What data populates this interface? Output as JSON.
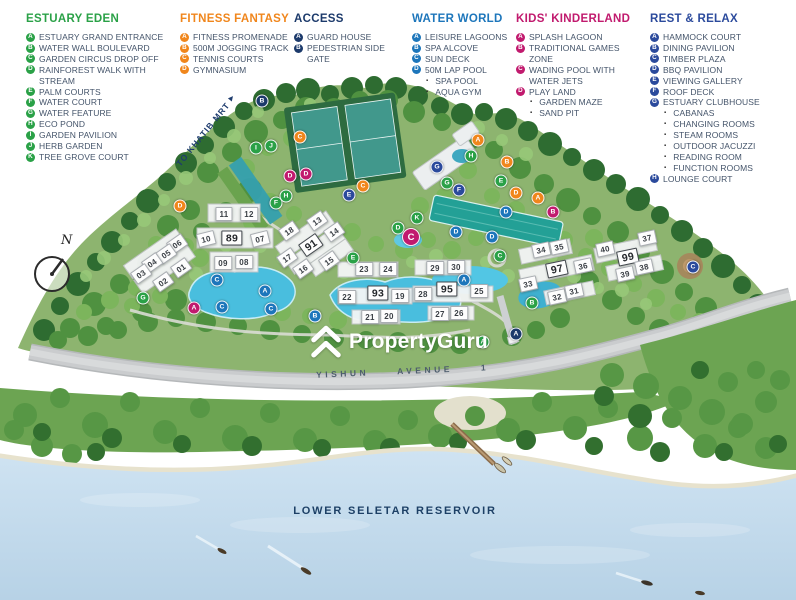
{
  "colors": {
    "estuary": "#2aa147",
    "fitness": "#f0861c",
    "access": "#1c3a6b",
    "water": "#1d76bb",
    "kids": "#c11a6e",
    "rest": "#2b4a9c"
  },
  "legend": [
    {
      "id": "estuary-eden",
      "title": "ESTUARY EDEN",
      "color": "#2aa147",
      "items": [
        {
          "k": "A",
          "label": "ESTUARY GRAND ENTRANCE"
        },
        {
          "k": "B",
          "label": "WATER WALL BOULEVARD"
        },
        {
          "k": "C",
          "label": "GARDEN CIRCUS DROP OFF"
        },
        {
          "k": "D",
          "label": "RAINFOREST WALK WITH STREAM"
        },
        {
          "k": "E",
          "label": "PALM COURTS"
        },
        {
          "k": "F",
          "label": "WATER COURT"
        },
        {
          "k": "G",
          "label": "WATER FEATURE"
        },
        {
          "k": "H",
          "label": "ECO POND"
        },
        {
          "k": "I",
          "label": "GARDEN PAVILION"
        },
        {
          "k": "J",
          "label": "HERB GARDEN"
        },
        {
          "k": "K",
          "label": "TREE GROVE COURT"
        }
      ]
    },
    {
      "id": "fitness-fantasy",
      "title": "FITNESS FANTASY",
      "color": "#f0861c",
      "items": [
        {
          "k": "A",
          "label": "FITNESS PROMENADE"
        },
        {
          "k": "B",
          "label": "500M JOGGING TRACK"
        },
        {
          "k": "C",
          "label": "TENNIS COURTS"
        },
        {
          "k": "D",
          "label": "GYMNASIUM"
        }
      ]
    },
    {
      "id": "access",
      "title": "ACCESS",
      "color": "#1c3a6b",
      "items": [
        {
          "k": "A",
          "label": "GUARD HOUSE"
        },
        {
          "k": "B",
          "label": "PEDESTRIAN SIDE GATE"
        }
      ]
    },
    {
      "id": "water-world",
      "title": "WATER WORLD",
      "color": "#1d76bb",
      "items": [
        {
          "k": "A",
          "label": "LEISURE LAGOONS"
        },
        {
          "k": "B",
          "label": "SPA ALCOVE"
        },
        {
          "k": "C",
          "label": "SUN DECK"
        },
        {
          "k": "D",
          "label": "50M LAP POOL"
        },
        {
          "label": "SPA POOL",
          "sub": true
        },
        {
          "label": "AQUA GYM",
          "sub": true
        }
      ]
    },
    {
      "id": "kids-kinderland",
      "title": "KIDS' KINDERLAND",
      "color": "#c11a6e",
      "items": [
        {
          "k": "A",
          "label": "SPLASH LAGOON"
        },
        {
          "k": "B",
          "label": "TRADITIONAL GAMES ZONE"
        },
        {
          "k": "C",
          "label": "WADING POOL WITH WATER JETS"
        },
        {
          "k": "D",
          "label": "PLAY LAND"
        },
        {
          "label": "GARDEN MAZE",
          "sub": true
        },
        {
          "label": "SAND PIT",
          "sub": true
        }
      ]
    },
    {
      "id": "rest-relax",
      "title": "REST & RELAX",
      "color": "#2b4a9c",
      "items": [
        {
          "k": "A",
          "label": "HAMMOCK COURT"
        },
        {
          "k": "B",
          "label": "DINING PAVILION"
        },
        {
          "k": "C",
          "label": "TIMBER PLAZA"
        },
        {
          "k": "D",
          "label": "BBQ PAVILION"
        },
        {
          "k": "E",
          "label": "VIEWING GALLERY"
        },
        {
          "k": "F",
          "label": "ROOF DECK"
        },
        {
          "k": "G",
          "label": "ESTUARY CLUBHOUSE"
        },
        {
          "label": "CABANAS",
          "sub": true
        },
        {
          "label": "CHANGING ROOMS",
          "sub": true
        },
        {
          "label": "STEAM ROOMS",
          "sub": true
        },
        {
          "label": "OUTDOOR JACUZZI",
          "sub": true
        },
        {
          "label": "READING ROOM",
          "sub": true
        },
        {
          "label": "FUNCTION ROOMS",
          "sub": true
        },
        {
          "k": "H",
          "label": "LOUNGE COURT"
        }
      ]
    }
  ],
  "map": {
    "khatib_label": "TO KHATIB MRT",
    "north_label": "N",
    "watermark": "PropertyGuru",
    "road_words": [
      "YISHUN",
      "AVENUE",
      "1"
    ],
    "reservoir_label": "LOWER SELETAR RESERVOIR",
    "buildings": [
      {
        "n": "11",
        "x": 224,
        "y": 214,
        "r": 0
      },
      {
        "n": "12",
        "x": 249,
        "y": 214,
        "r": 0
      },
      {
        "n": "10",
        "x": 206,
        "y": 239,
        "r": -14
      },
      {
        "n": "89",
        "x": 232,
        "y": 238,
        "r": 0,
        "b": true
      },
      {
        "n": "07",
        "x": 260,
        "y": 239,
        "r": -14
      },
      {
        "n": "09",
        "x": 223,
        "y": 263,
        "r": 0
      },
      {
        "n": "08",
        "x": 244,
        "y": 262,
        "r": 0
      },
      {
        "n": "06",
        "x": 177,
        "y": 244,
        "r": -35
      },
      {
        "n": "05",
        "x": 166,
        "y": 254,
        "r": -35
      },
      {
        "n": "04",
        "x": 152,
        "y": 263,
        "r": -35
      },
      {
        "n": "03",
        "x": 141,
        "y": 274,
        "r": -35
      },
      {
        "n": "02",
        "x": 163,
        "y": 282,
        "r": -35
      },
      {
        "n": "01",
        "x": 181,
        "y": 268,
        "r": -35
      },
      {
        "n": "18",
        "x": 289,
        "y": 231,
        "r": -35
      },
      {
        "n": "13",
        "x": 317,
        "y": 221,
        "r": -35
      },
      {
        "n": "14",
        "x": 334,
        "y": 232,
        "r": -35
      },
      {
        "n": "91",
        "x": 311,
        "y": 245,
        "r": -35,
        "b": true
      },
      {
        "n": "17",
        "x": 287,
        "y": 258,
        "r": -35
      },
      {
        "n": "15",
        "x": 329,
        "y": 261,
        "r": -35
      },
      {
        "n": "16",
        "x": 303,
        "y": 269,
        "r": -35
      },
      {
        "n": "23",
        "x": 364,
        "y": 269,
        "r": 0
      },
      {
        "n": "24",
        "x": 388,
        "y": 269,
        "r": 0
      },
      {
        "n": "22",
        "x": 347,
        "y": 297,
        "r": 0
      },
      {
        "n": "93",
        "x": 378,
        "y": 293,
        "r": 0,
        "b": true
      },
      {
        "n": "19",
        "x": 400,
        "y": 296,
        "r": 0
      },
      {
        "n": "21",
        "x": 370,
        "y": 317,
        "r": 0
      },
      {
        "n": "20",
        "x": 389,
        "y": 316,
        "r": 0
      },
      {
        "n": "29",
        "x": 435,
        "y": 268,
        "r": 0
      },
      {
        "n": "30",
        "x": 456,
        "y": 267,
        "r": 0
      },
      {
        "n": "28",
        "x": 423,
        "y": 294,
        "r": 0
      },
      {
        "n": "95",
        "x": 447,
        "y": 289,
        "r": 0,
        "b": true
      },
      {
        "n": "25",
        "x": 479,
        "y": 291,
        "r": 0
      },
      {
        "n": "27",
        "x": 440,
        "y": 314,
        "r": 0
      },
      {
        "n": "26",
        "x": 459,
        "y": 313,
        "r": 0
      },
      {
        "n": "34",
        "x": 541,
        "y": 250,
        "r": -12
      },
      {
        "n": "35",
        "x": 559,
        "y": 247,
        "r": -12
      },
      {
        "n": "97",
        "x": 557,
        "y": 269,
        "r": -12,
        "b": true
      },
      {
        "n": "36",
        "x": 583,
        "y": 266,
        "r": -12
      },
      {
        "n": "33",
        "x": 528,
        "y": 284,
        "r": -12
      },
      {
        "n": "32",
        "x": 557,
        "y": 297,
        "r": -12
      },
      {
        "n": "31",
        "x": 574,
        "y": 291,
        "r": -12
      },
      {
        "n": "40",
        "x": 605,
        "y": 249,
        "r": -12
      },
      {
        "n": "37",
        "x": 647,
        "y": 238,
        "r": -12
      },
      {
        "n": "99",
        "x": 628,
        "y": 257,
        "r": -12,
        "b": true
      },
      {
        "n": "39",
        "x": 625,
        "y": 274,
        "r": -12
      },
      {
        "n": "38",
        "x": 644,
        "y": 267,
        "r": -12
      }
    ],
    "markers": [
      {
        "c": "access",
        "l": "B",
        "x": 262,
        "y": 101
      },
      {
        "c": "access",
        "l": "A",
        "x": 516,
        "y": 334
      },
      {
        "c": "fitness",
        "l": "C",
        "x": 300,
        "y": 137
      },
      {
        "c": "fitness",
        "l": "C",
        "x": 363,
        "y": 186
      },
      {
        "c": "fitness",
        "l": "D",
        "x": 180,
        "y": 206
      },
      {
        "c": "fitness",
        "l": "A",
        "x": 478,
        "y": 140
      },
      {
        "c": "fitness",
        "l": "B",
        "x": 507,
        "y": 162
      },
      {
        "c": "fitness",
        "l": "A",
        "x": 538,
        "y": 198
      },
      {
        "c": "fitness",
        "l": "D",
        "x": 516,
        "y": 193
      },
      {
        "c": "estuary",
        "l": "I",
        "x": 256,
        "y": 148
      },
      {
        "c": "estuary",
        "l": "J",
        "x": 271,
        "y": 146
      },
      {
        "c": "estuary",
        "l": "F",
        "x": 276,
        "y": 203
      },
      {
        "c": "estuary",
        "l": "H",
        "x": 286,
        "y": 196
      },
      {
        "c": "estuary",
        "l": "H",
        "x": 471,
        "y": 156
      },
      {
        "c": "estuary",
        "l": "K",
        "x": 417,
        "y": 218
      },
      {
        "c": "estuary",
        "l": "D",
        "x": 398,
        "y": 228
      },
      {
        "c": "estuary",
        "l": "E",
        "x": 353,
        "y": 258
      },
      {
        "c": "estuary",
        "l": "E",
        "x": 501,
        "y": 181
      },
      {
        "c": "estuary",
        "l": "G",
        "x": 447,
        "y": 183
      },
      {
        "c": "estuary",
        "l": "G",
        "x": 143,
        "y": 298
      },
      {
        "c": "estuary",
        "l": "C",
        "x": 500,
        "y": 256
      },
      {
        "c": "estuary",
        "l": "B",
        "x": 532,
        "y": 303
      },
      {
        "c": "estuary",
        "l": "A",
        "x": 483,
        "y": 342
      },
      {
        "c": "water",
        "l": "C",
        "x": 217,
        "y": 280
      },
      {
        "c": "water",
        "l": "C",
        "x": 222,
        "y": 307
      },
      {
        "c": "water",
        "l": "C",
        "x": 271,
        "y": 309
      },
      {
        "c": "water",
        "l": "A",
        "x": 265,
        "y": 291
      },
      {
        "c": "water",
        "l": "A",
        "x": 464,
        "y": 280
      },
      {
        "c": "water",
        "l": "B",
        "x": 315,
        "y": 316
      },
      {
        "c": "water",
        "l": "D",
        "x": 456,
        "y": 232
      },
      {
        "c": "water",
        "l": "D",
        "x": 492,
        "y": 237
      },
      {
        "c": "water",
        "l": "D",
        "x": 506,
        "y": 212
      },
      {
        "c": "kids",
        "l": "A",
        "x": 194,
        "y": 308
      },
      {
        "c": "kids",
        "l": "D",
        "x": 290,
        "y": 176
      },
      {
        "c": "kids",
        "l": "D",
        "x": 306,
        "y": 174
      },
      {
        "c": "kids",
        "l": "C",
        "x": 411,
        "y": 237,
        "big": true
      },
      {
        "c": "kids",
        "l": "B",
        "x": 553,
        "y": 212
      },
      {
        "c": "rest",
        "l": "E",
        "x": 349,
        "y": 195
      },
      {
        "c": "rest",
        "l": "F",
        "x": 459,
        "y": 190
      },
      {
        "c": "rest",
        "l": "G",
        "x": 437,
        "y": 167
      },
      {
        "c": "rest",
        "l": "C",
        "x": 693,
        "y": 267
      }
    ]
  }
}
